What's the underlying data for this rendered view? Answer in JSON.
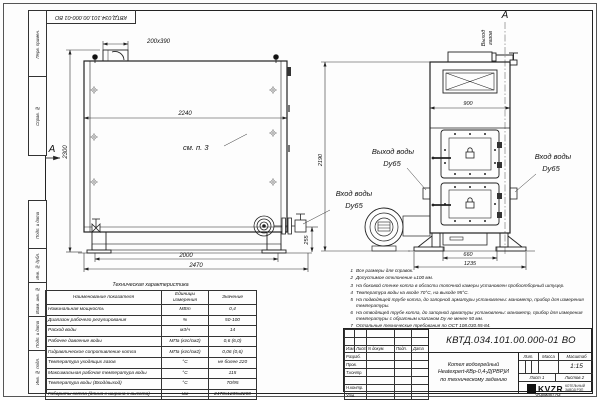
{
  "stamp": {
    "doc_number": "КВТД.034.101.00.000-01 ВО"
  },
  "margin_labels": {
    "items": [
      "Перв. примен.",
      "Справ. №",
      "Подп. и дата",
      "Инв. № дубл.",
      "Взам. инв. №",
      "Подп. и дата",
      "Инв. № подл."
    ]
  },
  "side_view": {
    "section_label": "А",
    "dim_chimney": "200х390",
    "dim_width": "2240",
    "dim_height": "2300",
    "note_ref": "см. п. 3",
    "dim_frame": "2000",
    "dim_length": "2470",
    "dim_flange": "255",
    "inlet_line1": "Вход воды",
    "inlet_line2": "Dy65"
  },
  "front_view": {
    "section_label": "А",
    "gas_line1": "Выход",
    "gas_line2": "газов",
    "dim_width": "900",
    "dim_height": "2190",
    "dim_doors": "660",
    "dim_base": "1235",
    "outlet_line1": "Выход воды",
    "outlet_line2": "Dy65",
    "inlet_line1": "Вход воды",
    "inlet_line2": "Dy65"
  },
  "tech_table": {
    "title": "Техническая характеристика",
    "headers": [
      "Наименование показателя",
      "Единицы измерения",
      "Значение"
    ],
    "rows": [
      [
        "Номинальная мощность",
        "МВт",
        "0,4"
      ],
      [
        "Диапазон рабочего регулирования",
        "%",
        "50-100"
      ],
      [
        "Расход воды",
        "м3/ч",
        "14"
      ],
      [
        "Рабочее давление воды",
        "МПа (кгс/см2)",
        "0,6 (6,0)"
      ],
      [
        "Гидравлическое сопротивление котла",
        "МПа (кгс/см2)",
        "0,06 (0,6)"
      ],
      [
        "Температура уходящих газов",
        "°С",
        "не более 220"
      ],
      [
        "Максимальная рабочая температура воды",
        "°С",
        "115"
      ],
      [
        "Температура воды (Вход/выход)",
        "°С",
        "70/95"
      ],
      [
        "Габариты котла (длина х ширина х высота)",
        "мм",
        "2470х1235х2200"
      ]
    ]
  },
  "notes": {
    "items": [
      {
        "n": "1",
        "text": "Все размеры для справок."
      },
      {
        "n": "2",
        "text": "Допустимое отклонение ±100 мм."
      },
      {
        "n": "3",
        "text": "На боковой стенке котла в области топочной камеры установлен пробоотборный штуцер."
      },
      {
        "n": "4",
        "text": "Температура воды на входе 70°С, на выходе 95°С."
      },
      {
        "n": "5",
        "text": "На подводящей трубе котла, до запорной арматуры установлены: манометр, прибор для измерения температуры."
      },
      {
        "n": "6",
        "text": "На отводящей трубе котла, до запорной арматуры установлены: манометр, прибор для измерения температуры с обратным клапаном Dу не менее 50 мм."
      },
      {
        "n": "7",
        "text": "Остальные технические требования по ОСТ 108.030.55-84."
      }
    ]
  },
  "title_block": {
    "doc_number": "КВТД.034.101.00.000-01 ВО",
    "title_line1": "Котел водогрейный",
    "title_line2": "Heatexpert-КВр-0,4-Д(РВР)И",
    "title_line3": "по техническому заданию",
    "header_cols": [
      "Изм.",
      "Лист",
      "N докум.",
      "Подп.",
      "Дата"
    ],
    "rows": [
      "Разраб.",
      "Пров.",
      "Т.контр.",
      "Н.контр.",
      "Утв."
    ],
    "lit_label": "Лит.",
    "mass_label": "Масса",
    "scale_label": "Масштаб",
    "scale_value": "1:15",
    "sheet_label": "Лист",
    "sheet_value": "1",
    "sheets_label": "Листов",
    "sheets_value": "2",
    "logo_text": "KVZR",
    "logo_sub1": "КОТЕЛЬНЫЙ",
    "logo_sub2": "ЗАВОД РЭП",
    "format_label": "Формат  А3"
  }
}
